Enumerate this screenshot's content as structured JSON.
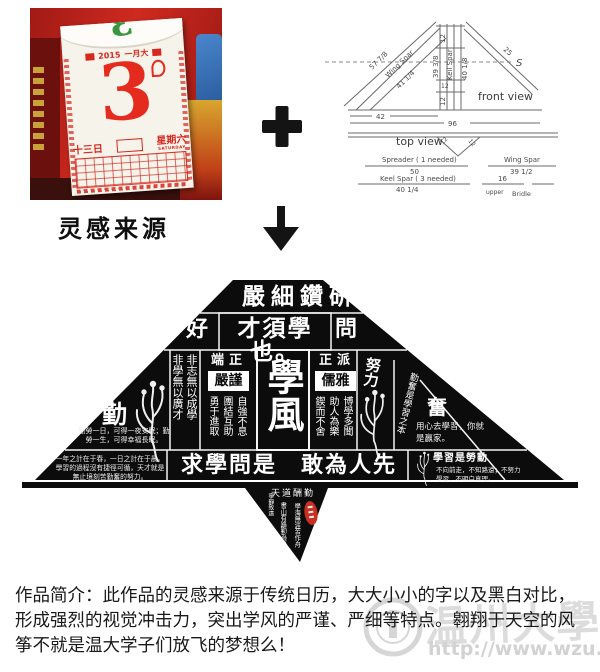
{
  "inspiration": {
    "label": "灵感来源",
    "calendar": {
      "peek_number": "3",
      "year": "2015",
      "month": "一月大",
      "day": "3",
      "date": "十三日",
      "weekday": "星期六",
      "weekday_en": "SATURDAY"
    }
  },
  "icons": {
    "plus": "+",
    "down_arrow": "↓"
  },
  "diagram": {
    "front_view_label": "front view",
    "top_view_label": "top view",
    "side_label": "S",
    "dims": {
      "left_outer": "57 7/8",
      "wing_spar": "Wing Spar",
      "left_inner": "41 1/4",
      "right_diag": "25",
      "post_top": "12",
      "post_left": "39 3/8",
      "keel_spar": "Keil Spar",
      "post_right": "40 1/8",
      "post_mid": "12",
      "post_bottom": "12",
      "base_left": "42",
      "base_total": "96",
      "v_left": "12",
      "v_right": "12"
    },
    "parts": {
      "spreader_name": "Spreader ( 1 needed)",
      "spreader_len": "50",
      "keel_name": "Keel Spar ( 3 needed)",
      "keel_len": "40 1/4",
      "wing_name": "Wing Spar",
      "wing_len": "39 1/2",
      "bridle_len": "16",
      "bridle_upper": "upper",
      "bridle_label": "Bridle"
    }
  },
  "kite": {
    "top_banner": "嚴細鑽研",
    "row2": {
      "left": "好",
      "center": "才須學也。",
      "right": "問"
    },
    "left_columns": {
      "c1": "非志無以成學",
      "c2": "非學無以廣才"
    },
    "panel_left": {
      "header": "端正",
      "boxed": "嚴謹",
      "cols": [
        "自強不息",
        "團結互助",
        "勇于進取"
      ]
    },
    "center_main": "學風",
    "panel_right": {
      "header": "正派",
      "boxed": "儒雅",
      "cols": [
        "博學多聞",
        "助人為樂",
        "鍥而不舍"
      ]
    },
    "left_wing": {
      "char": "勤",
      "quote": "勤勞一日，可得一夜安眠；勤勞一生，可得幸福長眠。"
    },
    "right_wing": {
      "chars": "努力",
      "band": "勤奮是學習之本",
      "char": "奮",
      "quote": "用心去學習，你就是贏家。"
    },
    "bottom_banner": "求學問是　敢為人先",
    "bottom_left_quote": "一年之計在于春，一日之計在于晨。學習的過程沒有捷徑可循，天才就是無止境刻苦勤奮的努力。",
    "bottom_right": {
      "title": "學習是勞動",
      "quote": "不向前走，不知路遠；不努力學習，不明白真理。"
    },
    "tail": {
      "motto": "天道酬勤",
      "col1": "學海無涯苦作舟",
      "col2": "書山有路勤為徑",
      "col3": "寧靜致遠"
    }
  },
  "description": "作品简介：此作品的灵感来源于传统日历，大大小小的字以及黑白对比，形成强烈的视觉冲击力，突出学风的严谨、严细等特点。翱翔于天空的风筝不就是温大学子们放飞的梦想么！",
  "watermark": {
    "name": "温州大學",
    "url": "http://www.wzu.edu.cn"
  },
  "colors": {
    "kite_bg": "#0c0c0c",
    "calendar_red": "#d5281e",
    "seal_red": "#c53022",
    "watermark_gray": "#dcdcdc"
  }
}
